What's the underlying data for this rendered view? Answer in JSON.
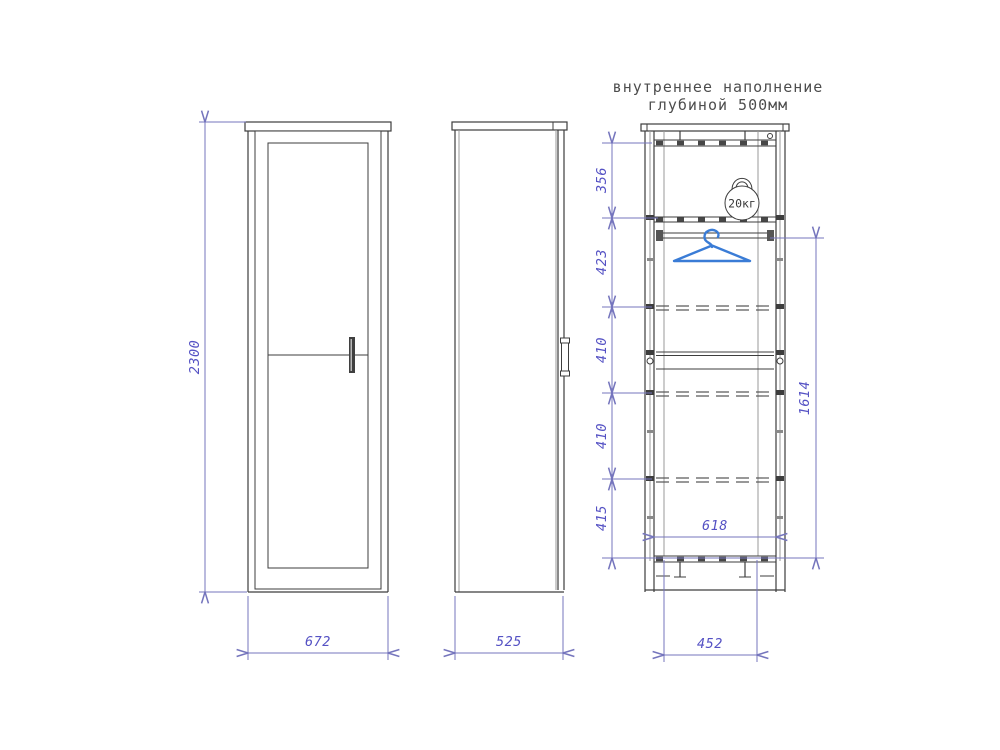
{
  "title": {
    "line1": "внутреннее наполнение",
    "line2": "глубиной 500мм"
  },
  "dims": {
    "front_height": "2300",
    "front_width": "672",
    "side_depth": "525",
    "internal_bottom_width": "452",
    "internal_inner_width": "618",
    "hanging_zone_height": "1614",
    "sections": [
      "356",
      "423",
      "410",
      "410",
      "415"
    ]
  },
  "icons": {
    "kettlebell": "kettlebell-icon",
    "kettlebell_label": "20кг",
    "hanger": "hanger-icon"
  },
  "colors": {
    "background": "#ffffff",
    "drawing_line": "#3d3d3d",
    "secondary_line": "#9a9a9a",
    "dimension_line": "#7575bd",
    "dimension_text": "#5552c4",
    "title_text": "#4d4d4d",
    "hanger_blue": "#3a7cd6"
  }
}
